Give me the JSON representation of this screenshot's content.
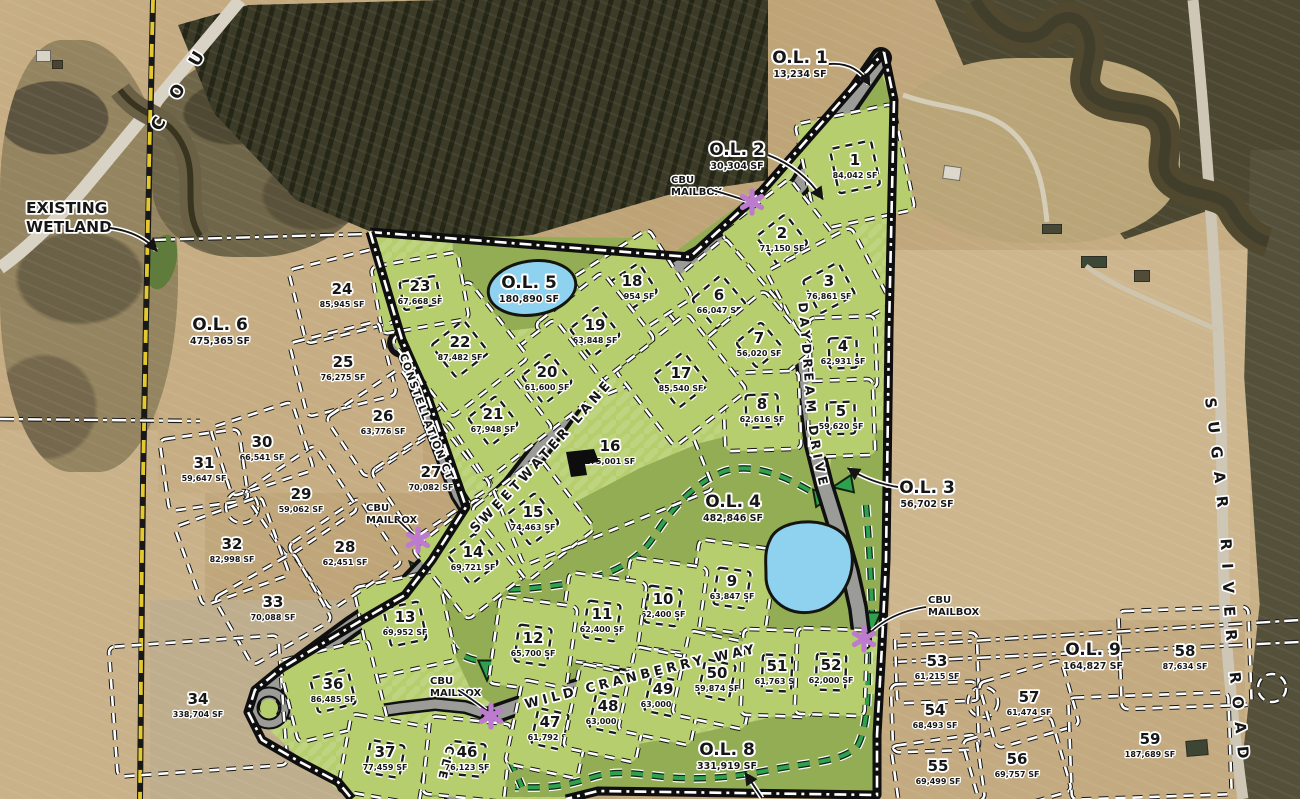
{
  "map": {
    "region_labels": {
      "existing_wetland": {
        "lines": [
          "EXISTING",
          "WETLAND"
        ],
        "x": 26,
        "y": 213
      }
    },
    "roads": {
      "sweetwater": "SWEETWATER LANE",
      "daydream": "DAYDREAM DRIVE",
      "wild_cranberry": "WILD CRANBERRY WAY",
      "constellation": "CONSTELLATION CT",
      "circle_partial": "CLE",
      "county_partial": "C O U",
      "sugar_river": "SUGAR RIVER ROAD"
    },
    "mailbox_label": [
      "CBU",
      "MAILBOX"
    ],
    "mailboxes": [
      {
        "tx": 671,
        "ty": 183,
        "ax": 752,
        "ay": 202
      },
      {
        "tx": 366,
        "ty": 511,
        "ax": 418,
        "ay": 540
      },
      {
        "tx": 430,
        "ty": 684,
        "ax": 491,
        "ay": 716
      },
      {
        "tx": 928,
        "ty": 603,
        "ax": 864,
        "ay": 639
      }
    ],
    "outlots": [
      {
        "name": "O.L. 1",
        "sf": "13,234 SF",
        "x": 800,
        "y": 58
      },
      {
        "name": "O.L. 2",
        "sf": "30,304 SF",
        "x": 737,
        "y": 150
      },
      {
        "name": "O.L. 3",
        "sf": "56,702 SF",
        "x": 927,
        "y": 488
      },
      {
        "name": "O.L. 4",
        "sf": "482,846 SF",
        "x": 733,
        "y": 502
      },
      {
        "name": "O.L. 5",
        "sf": "180,890 SF",
        "x": 529,
        "y": 283
      },
      {
        "name": "O.L. 6",
        "sf": "475,365 SF",
        "x": 220,
        "y": 325
      },
      {
        "name": "O.L. 8",
        "sf": "331,919 SF",
        "x": 727,
        "y": 750
      },
      {
        "name": "O.L. 9",
        "sf": "164,827 SF",
        "x": 1093,
        "y": 650
      }
    ],
    "lots": [
      {
        "n": "1",
        "sf": "84,042 SF",
        "x": 855,
        "y": 167,
        "w": 100,
        "h": 108,
        "r": -12,
        "env": true
      },
      {
        "n": "2",
        "sf": "71,150 SF",
        "x": 782,
        "y": 240,
        "w": 88,
        "h": 88,
        "r": -38,
        "env": true
      },
      {
        "n": "3",
        "sf": "76,861 SF",
        "x": 829,
        "y": 288,
        "w": 96,
        "h": 88,
        "r": -28,
        "env": true
      },
      {
        "n": "4",
        "sf": "62,931 SF",
        "x": 843,
        "y": 353,
        "w": 66,
        "h": 72,
        "r": -2,
        "env": true
      },
      {
        "n": "5",
        "sf": "59,620 SF",
        "x": 841,
        "y": 418,
        "w": 66,
        "h": 76,
        "r": -2,
        "env": true
      },
      {
        "n": "6",
        "sf": "66,047 SF",
        "x": 719,
        "y": 302,
        "w": 92,
        "h": 92,
        "r": -40,
        "env": true
      },
      {
        "n": "7",
        "sf": "56,020 SF",
        "x": 759,
        "y": 345,
        "w": 78,
        "h": 78,
        "r": -40,
        "env": true
      },
      {
        "n": "8",
        "sf": "62,616 SF",
        "x": 762,
        "y": 411,
        "w": 76,
        "h": 78,
        "r": -2,
        "env": true
      },
      {
        "n": "9",
        "sf": "63,847 SF",
        "x": 732,
        "y": 588,
        "w": 78,
        "h": 88,
        "r": 8,
        "env": true
      },
      {
        "n": "10",
        "sf": "62,400 SF",
        "x": 663,
        "y": 606,
        "w": 78,
        "h": 88,
        "r": 8,
        "env": true
      },
      {
        "n": "11",
        "sf": "62,400 SF",
        "x": 602,
        "y": 621,
        "w": 78,
        "h": 88,
        "r": 8,
        "env": true
      },
      {
        "n": "12",
        "sf": "65,700 SF",
        "x": 533,
        "y": 645,
        "w": 78,
        "h": 88,
        "r": 8,
        "env": true
      },
      {
        "n": "13",
        "sf": "69,952 SF",
        "x": 405,
        "y": 624,
        "w": 86,
        "h": 92,
        "r": -12,
        "env": true
      },
      {
        "n": "14",
        "sf": "69,721 SF",
        "x": 473,
        "y": 559,
        "w": 84,
        "h": 90,
        "r": -38,
        "env": true
      },
      {
        "n": "15",
        "sf": "74,463 SF",
        "x": 533,
        "y": 519,
        "w": 86,
        "h": 92,
        "r": -38,
        "env": true
      },
      {
        "n": "16",
        "sf": "175,001 SF",
        "x": 595,
        "y": 468,
        "w": 205,
        "h": 128,
        "r": -22,
        "env": false,
        "ox": 15,
        "oy": -15
      },
      {
        "n": "17",
        "sf": "85,540 SF",
        "x": 681,
        "y": 380,
        "w": 92,
        "h": 98,
        "r": -38,
        "env": true
      },
      {
        "n": "18",
        "sf": "56,954 SF",
        "x": 632,
        "y": 288,
        "w": 92,
        "h": 82,
        "r": -33,
        "env": true
      },
      {
        "n": "19",
        "sf": "63,848 SF",
        "x": 595,
        "y": 332,
        "w": 86,
        "h": 86,
        "r": -38,
        "env": true
      },
      {
        "n": "20",
        "sf": "61,600 SF",
        "x": 547,
        "y": 379,
        "w": 86,
        "h": 86,
        "r": -38,
        "env": true
      },
      {
        "n": "21",
        "sf": "67,948 SF",
        "x": 493,
        "y": 421,
        "w": 86,
        "h": 86,
        "r": -38,
        "env": true
      },
      {
        "n": "22",
        "sf": "87,482 SF",
        "x": 460,
        "y": 349,
        "w": 98,
        "h": 98,
        "r": -38,
        "env": true
      },
      {
        "n": "23",
        "sf": "67,668 SF",
        "x": 420,
        "y": 293,
        "w": 88,
        "h": 68,
        "r": -10,
        "env": true
      },
      {
        "n": "24",
        "sf": "85,945 SF",
        "x": 342,
        "y": 296,
        "w": 92,
        "h": 76,
        "r": -14,
        "env": false
      },
      {
        "n": "25",
        "sf": "76,275 SF",
        "x": 343,
        "y": 369,
        "w": 92,
        "h": 76,
        "r": -14,
        "env": false
      },
      {
        "n": "26",
        "sf": "63,776 SF",
        "x": 383,
        "y": 423,
        "w": 90,
        "h": 72,
        "r": -34,
        "env": false
      },
      {
        "n": "27",
        "sf": "70,082 SF",
        "x": 431,
        "y": 479,
        "w": 92,
        "h": 80,
        "r": -34,
        "env": false
      },
      {
        "n": "28",
        "sf": "62,451 SF",
        "x": 345,
        "y": 554,
        "w": 86,
        "h": 78,
        "r": -34,
        "env": false
      },
      {
        "n": "29",
        "sf": "59,062 SF",
        "x": 301,
        "y": 501,
        "w": 86,
        "h": 78,
        "r": -34,
        "env": false
      },
      {
        "n": "30",
        "sf": "66,541 SF",
        "x": 262,
        "y": 449,
        "w": 86,
        "h": 72,
        "r": -18,
        "env": false
      },
      {
        "n": "31",
        "sf": "59,647 SF",
        "x": 204,
        "y": 470,
        "w": 80,
        "h": 72,
        "r": -8,
        "env": false
      },
      {
        "n": "32",
        "sf": "82,998 SF",
        "x": 232,
        "y": 551,
        "w": 92,
        "h": 84,
        "r": -20,
        "env": false
      },
      {
        "n": "33",
        "sf": "70,088 SF",
        "x": 273,
        "y": 609,
        "w": 92,
        "h": 78,
        "r": -30,
        "env": false
      },
      {
        "n": "34",
        "sf": "338,704 SF",
        "x": 198,
        "y": 706,
        "w": 170,
        "h": 130,
        "r": -4,
        "env": false
      },
      {
        "n": "36",
        "sf": "86,485 SF",
        "x": 333,
        "y": 691,
        "w": 92,
        "h": 84,
        "r": -14,
        "env": true
      },
      {
        "n": "37",
        "sf": "77,459 SF",
        "x": 385,
        "y": 759,
        "w": 82,
        "h": 78,
        "r": 10,
        "env": true
      },
      {
        "n": "46",
        "sf": "76,123 SF",
        "x": 467,
        "y": 759,
        "w": 82,
        "h": 78,
        "r": 6,
        "env": true
      },
      {
        "n": "47",
        "sf": "61,792 SF",
        "x": 550,
        "y": 729,
        "w": 74,
        "h": 86,
        "r": 12,
        "env": true
      },
      {
        "n": "48",
        "sf": "63,000 SF",
        "x": 608,
        "y": 713,
        "w": 74,
        "h": 86,
        "r": 12,
        "env": true
      },
      {
        "n": "49",
        "sf": "63,000 SF",
        "x": 663,
        "y": 696,
        "w": 74,
        "h": 86,
        "r": 12,
        "env": true
      },
      {
        "n": "50",
        "sf": "59,874 SF",
        "x": 717,
        "y": 680,
        "w": 74,
        "h": 86,
        "r": 12,
        "env": true
      },
      {
        "n": "51",
        "sf": "61,763 SF",
        "x": 777,
        "y": 673,
        "w": 70,
        "h": 86,
        "r": 2,
        "env": true
      },
      {
        "n": "52",
        "sf": "62,000 SF",
        "x": 831,
        "y": 672,
        "w": 70,
        "h": 86,
        "r": 2,
        "env": true
      },
      {
        "n": "53",
        "sf": "61,215 SF",
        "x": 937,
        "y": 668,
        "w": 82,
        "h": 68,
        "r": -2,
        "env": false
      },
      {
        "n": "54",
        "sf": "68,493 SF",
        "x": 935,
        "y": 717,
        "w": 86,
        "h": 68,
        "r": -2,
        "env": false
      },
      {
        "n": "55",
        "sf": "69,499 SF",
        "x": 938,
        "y": 773,
        "w": 86,
        "h": 66,
        "r": -8,
        "env": false
      },
      {
        "n": "56",
        "sf": "69,757 SF",
        "x": 1017,
        "y": 766,
        "w": 92,
        "h": 78,
        "r": -16,
        "env": false
      },
      {
        "n": "57",
        "sf": "61,474 SF",
        "x": 1029,
        "y": 704,
        "w": 86,
        "h": 68,
        "r": -16,
        "env": false
      },
      {
        "n": "58",
        "sf": "87,634 SF",
        "x": 1185,
        "y": 658,
        "w": 130,
        "h": 98,
        "r": -2,
        "env": false
      },
      {
        "n": "59",
        "sf": "187,689 SF",
        "x": 1150,
        "y": 746,
        "w": 160,
        "h": 102,
        "r": -2,
        "env": false
      }
    ],
    "colors": {
      "lot_green": "#b6ce6e",
      "outlot_green": "#93ad54",
      "pond_blue": "#8fd2ef",
      "trail_green": "#2ea14f",
      "mailbox_purple": "#bd7bcf",
      "boundary_yellow": "#e3c92f"
    }
  }
}
